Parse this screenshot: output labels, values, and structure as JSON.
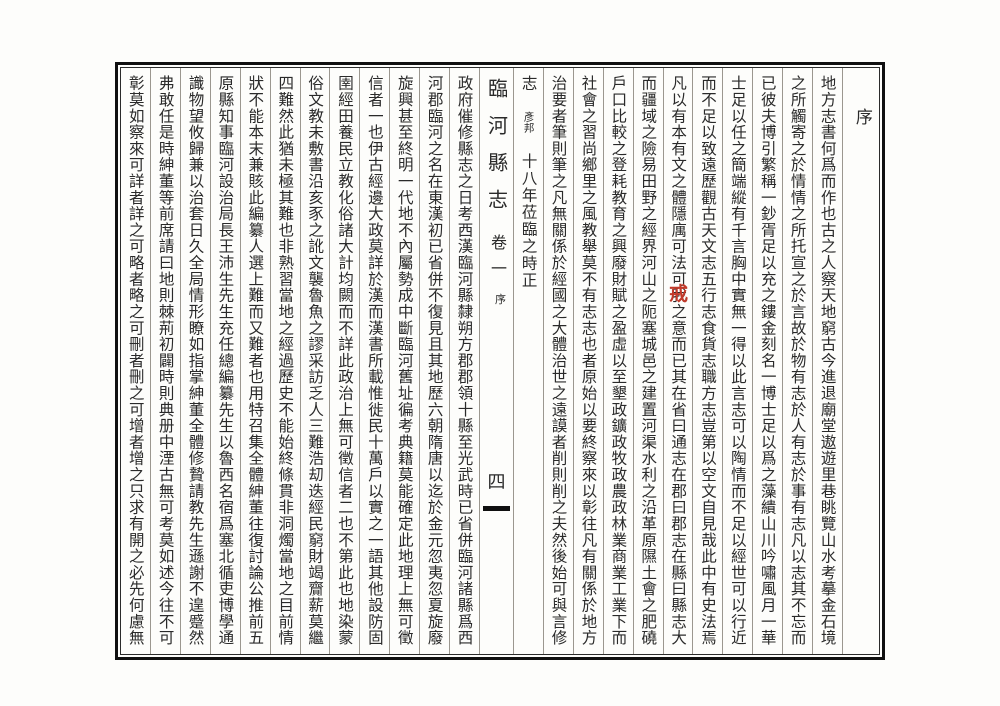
{
  "page": {
    "section_header": "序",
    "book_title": "臨河縣志",
    "volume_label": "卷一",
    "folio_section": "序",
    "page_number": "四",
    "seal_correction_char": "戒",
    "colors": {
      "ink": "#2a2a2a",
      "border": "#101010",
      "column_rule": "#9b978f",
      "seal_red": "#c23a2a",
      "paper": "#fdfdfb"
    }
  },
  "right_page_columns": [
    "地方志書何爲而作也古之人察天地窮古今進退廟堂遨遊里巷眺覽山水考摹金石境",
    "之所觸寄之於情情之所托宣之於言故於物有志於人有志於事有志凡以志其不忘而",
    "已彼夫博引繁稱一鈔胥足以充之鏤金刻名一博士足以爲之藻繢山川吟嘯風月一華",
    "士足以任之簡端縱有千言胸中實無一得以此言志可以陶情而不足以經世可以行近",
    "而不足以致遠歷觀古天文志五行志食貨志職方志豈第以空文自見哉此中有史法焉",
    "凡以有本有文之體隱庽可法可我之意而已其在省曰通志在郡曰郡志在縣曰縣志大",
    "而疆域之險易田野之經界河山之阨塞城邑之建置河渠水利之沿革原隰土會之肥磽",
    "戶口比較之登耗教育之興廢財賦之盈虛以至墾政鑛政牧政農政林業商業工業下而",
    "社會之習尚鄉里之風教舉莫不有志志也者原始以要終察來以彰往凡有關係於地方",
    "治要者筆則筆之凡無關係於經國之大體治世之遠謨者削則削之夫然後始可與言修"
  ],
  "signature_column": {
    "lead_char": "志",
    "author_name_small": "彥邦",
    "date_text": "十八年莅臨之時正"
  },
  "left_page_columns": [
    "政府催修縣志之日考西漢臨河縣隸朔方郡郡領十縣至光武時已省併臨河諸縣爲西",
    "河郡臨河之名在東漢初已省併不復見且其地歷六朝隋唐以迄於金元忽夷忽夏旋廢",
    "旋興甚至終明一代地不內屬勢成中斷臨河舊址徧考典籍莫能確定此地理上無可徵",
    "信者一也伊古經邊大政莫詳於漢而漢書所載惟徙民十萬戶以實之一語其他設防固",
    "圉經田養民立教化俗諸大計均闕而不詳此政治上無可徵信者二也不第此也地染蒙",
    "俗文教未敷書沿亥豕之訛文襲魯魚之謬采訪乏人三難浩刧迭經民窮財竭齎薪莫繼",
    "四難然此猶未極其難也非熟習當地之經過歷史不能始終條貫非洞燭當地之目前情",
    "狀不能本末兼賅此編纂人選上難而又難者也用特召集全體紳董往復討論公推前五",
    "原縣知事臨河設治局長王沛生先生充任總編纂先生以魯西名宿爲塞北循吏博學通",
    "識物望攸歸兼以治套日久全局情形瞭如指掌紳董全體修贄請教先生遜謝不遑蹙然",
    "弗敢任是時紳董等前席請曰地則棘荊初闢時則典册中湮古無可考莫如述今往不可",
    "彰莫如察來可詳者詳之可略者略之可刪者刪之可增者增之只求有開之必先何慮無"
  ]
}
